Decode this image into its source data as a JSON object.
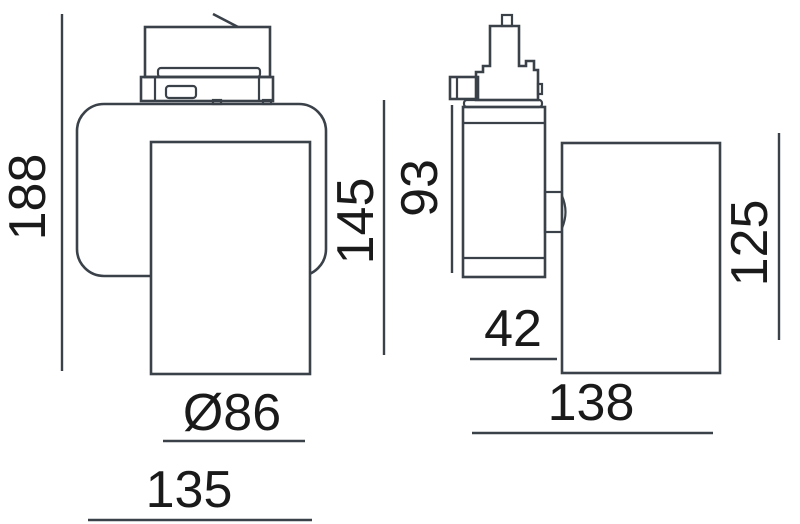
{
  "drawing": {
    "type": "technical-dimension-drawing",
    "subject": "track-spotlight-two-views",
    "unit": "mm",
    "colors": {
      "line": "#3a4149",
      "text": "#1a1a1a",
      "background": "#ffffff"
    },
    "views": {
      "front": "front-view-with-track-adapter",
      "side": "side-view-with-track-adapter"
    },
    "dims": {
      "overall_height": "188",
      "body_height": "145",
      "head_diameter": "Ø86",
      "body_width": "135",
      "arm_height": "93",
      "arm_depth": "42",
      "head_height": "125",
      "head_length": "138"
    }
  }
}
